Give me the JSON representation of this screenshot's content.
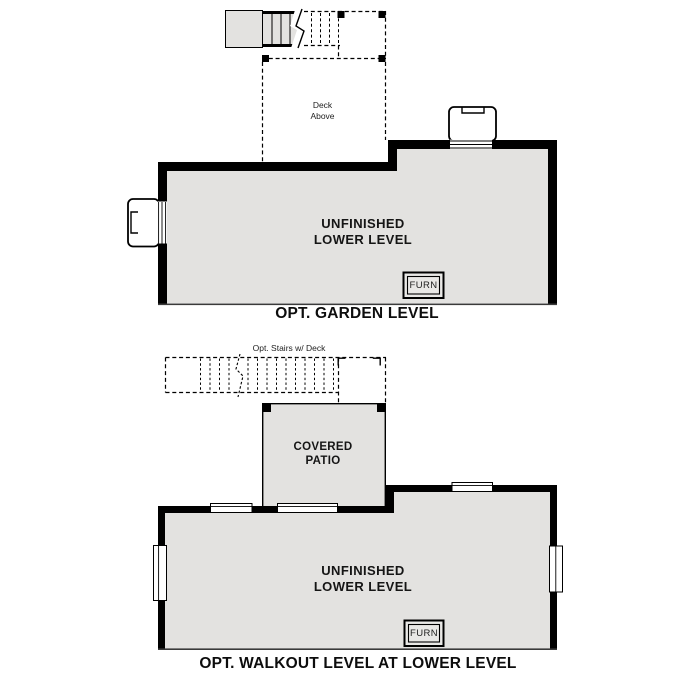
{
  "document": {
    "background_color": "#ffffff",
    "wall_color": "#000000",
    "floor_fill_color": "#e3e2e0"
  },
  "garden_level": {
    "title": "OPT. GARDEN LEVEL",
    "room_label_line1": "UNFINISHED",
    "room_label_line2": "LOWER LEVEL",
    "deck_label_line1": "Deck",
    "deck_label_line2": "Above",
    "furnace_label": "FURN"
  },
  "walkout_level": {
    "title": "OPT. WALKOUT LEVEL AT LOWER LEVEL",
    "stairs_label": "Opt. Stairs w/ Deck",
    "patio_label_line1": "COVERED",
    "patio_label_line2": "PATIO",
    "room_label_line1": "UNFINISHED",
    "room_label_line2": "LOWER LEVEL",
    "furnace_label": "FURN"
  }
}
